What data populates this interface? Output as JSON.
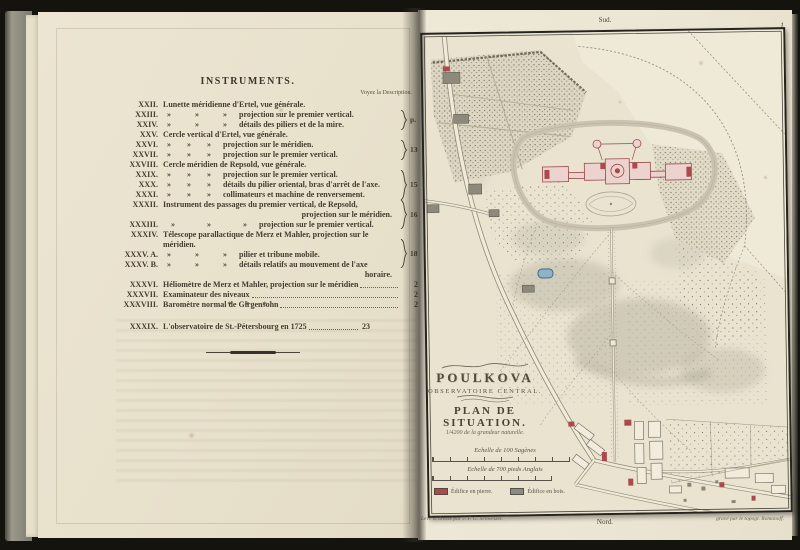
{
  "colors": {
    "paper": "#e9e3d0",
    "ink": "#443c2e",
    "edifice_pierre": "#a84a4e",
    "edifice_bois": "#8e8a7c",
    "pond": "#8fb2c9"
  },
  "left_page": {
    "title": "INSTRUMENTS.",
    "column_header": "Voyez la Description.",
    "rows": [
      {
        "num": "XXII.",
        "body": "Lunette méridienne d'Ertel, vue générale."
      },
      {
        "num": "XXIII.",
        "body": " »   »   »  projection sur le premier vertical."
      },
      {
        "num": "XXIV.",
        "body": " »   »   »  détails des piliers et de la mire."
      },
      {
        "num": "XXV.",
        "body": "Cercle vertical d'Ertel, vue générale."
      },
      {
        "num": "XXVI.",
        "body": " »  »  »  projection sur le méridien."
      },
      {
        "num": "XXVII.",
        "body": " »  »  »  projection sur le premier vertical."
      },
      {
        "num": "XXVIII.",
        "body": "Cercle méridien de Repsold, vue générale."
      },
      {
        "num": "XXIX.",
        "body": " »  »  »  projection sur le premier vertical."
      },
      {
        "num": "XXX.",
        "body": " »  »  »  détails du pilier oriental, bras d'arrêt de l'axe."
      },
      {
        "num": "XXXI.",
        "body": " »  »  »  collimateurs et machine de renversement."
      },
      {
        "num": "XXXII.",
        "body": "Instrument des passages du premier vertical, de Repsold, projection sur le méridien."
      },
      {
        "num": "XXXIII.",
        "body": " »    »    »  projection sur le premier vertical."
      },
      {
        "num": "XXXIV.",
        "body": "Télescope parallactique de Merz et Mahler, projection sur le méridien."
      },
      {
        "num": "XXXV. A.",
        "body": " »   »   »  pilier et tribune mobile."
      },
      {
        "num": "XXXV. B.",
        "body": " »   »   »  détails relatifs au mouvement de l'axe horaire."
      },
      {
        "num": "XXXVI.",
        "body": "Héliomètre de Merz et Mahler, projection sur le méridien",
        "page": "205"
      },
      {
        "num": "XXXVII.",
        "body": "Examinateur des niveaux",
        "page": "222"
      },
      {
        "num": "XXXVIII.",
        "body": "Baromètre normal de Girgensohn",
        "page": "224"
      },
      {
        "num": "XXXIX.",
        "body": "L'observatoire de St.-Pétersbourg en 1725",
        "page": "23"
      }
    ],
    "brace_labels": [
      "p. 115",
      "130",
      "150",
      "167",
      "181"
    ],
    "separator": "* * *"
  },
  "right_page": {
    "margin_top_label": "Sud.",
    "plate_number": "1",
    "map": {
      "title": "POULKOVA",
      "subtitle": "OBSERVATOIRE CENTRAL.",
      "plan_label": "PLAN DE SITUATION.",
      "scale_note": "1/4200 de la grandeur naturelle.",
      "scale_sagenes_label": "Echelle de 100 Sagènes",
      "scale_feet_label": "Echelle de 700 pieds Anglais",
      "legend": [
        {
          "label": "Édifice en pierre.",
          "color": "#a84a4e"
        },
        {
          "label": "Édifice en bois.",
          "color": "#8e8a7c"
        }
      ]
    },
    "credit_left": "Levé et dressé par J. F. G. Schweizer.",
    "credit_right": "gravé par le topogr. Romanoff.",
    "margin_bottom_label": "Nord."
  }
}
